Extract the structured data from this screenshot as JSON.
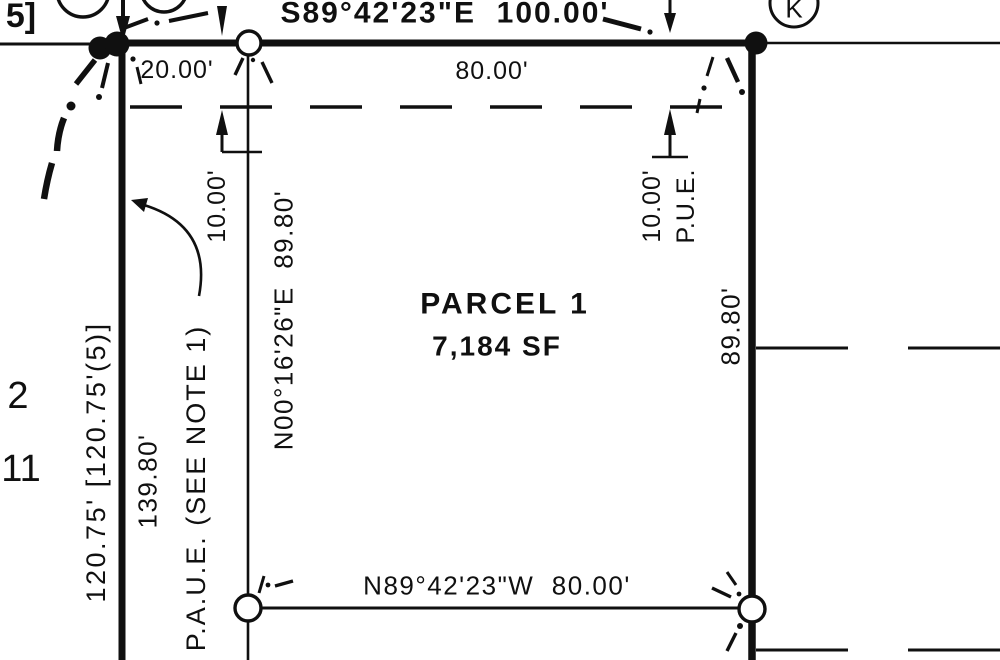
{
  "north_line": {
    "bearing": "S89°42'23\"E  100.00'",
    "west_offset_dim": "20.00'",
    "east_segment_dim": "80.00'"
  },
  "easement": {
    "left_width_dim": "10.00'",
    "right_width_dim": "10.00'",
    "right_label": "P.U.E.",
    "note": "P.A.U.E. (SEE NOTE 1)"
  },
  "parcel": {
    "name": "PARCEL 1",
    "area": "7,184 SF"
  },
  "west_line": {
    "bearing": "N00°16'26\"E  89.80'",
    "outer_dim": "120.75' [120.75'(5)]",
    "inner_dim": "139.80'"
  },
  "east_line": {
    "dim": "89.80'"
  },
  "south_line": {
    "bearing": "N89°42'23\"W  80.00'"
  },
  "margin": {
    "lot_number_upper": "2",
    "lot_number_lower": "11",
    "bracket_fragment": "5]"
  },
  "monuments": {
    "corner_letter": "K"
  },
  "colors": {
    "ink": "#101010",
    "paper": "#ffffff"
  }
}
